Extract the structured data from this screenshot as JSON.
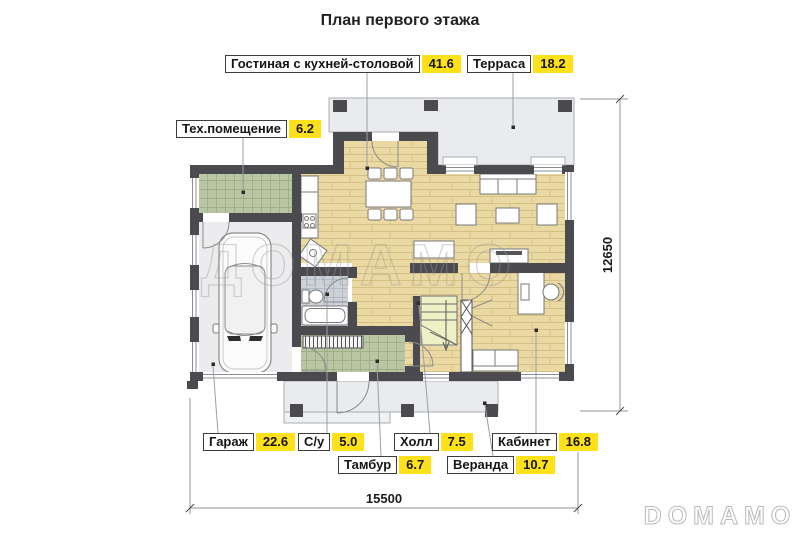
{
  "title": "План первого этажа",
  "watermarks": {
    "center": "ДОМАМО",
    "corner": "DOMAMO"
  },
  "dimensions": {
    "width": "15500",
    "depth": "12650"
  },
  "rooms": [
    {
      "key": "living-kitchen",
      "label": "Гостиная с кухней-столовой",
      "area": "41.6"
    },
    {
      "key": "terrace",
      "label": "Терраса",
      "area": "18.2"
    },
    {
      "key": "tech-room",
      "label": "Тех.помещение",
      "area": "6.2"
    },
    {
      "key": "garage",
      "label": "Гараж",
      "area": "22.6"
    },
    {
      "key": "bathroom",
      "label": "С/у",
      "area": "5.0"
    },
    {
      "key": "hall",
      "label": "Холл",
      "area": "7.5"
    },
    {
      "key": "cabinet",
      "label": "Кабинет",
      "area": "16.8"
    },
    {
      "key": "tambour",
      "label": "Тамбур",
      "area": "6.7"
    },
    {
      "key": "veranda",
      "label": "Веранда",
      "area": "10.7"
    }
  ],
  "colors": {
    "area_badge": "#ffe11a",
    "wall": "#4b4a4f",
    "wood_floor": "#ebd9a3",
    "tile_green": "#b9c6a4",
    "tile_gray": "#cdd2d9",
    "paving": "#e9ebec",
    "label_border": "#3c3c3c"
  }
}
